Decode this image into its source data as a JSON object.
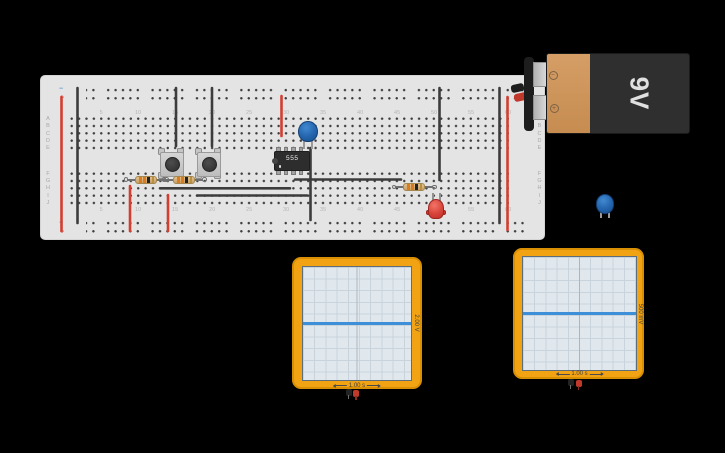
{
  "app": {
    "background": "#000000"
  },
  "breadboard": {
    "x": 40,
    "y": 75,
    "w": 505,
    "h": 165,
    "rail_minus": "−",
    "rail_plus": "+",
    "row_letters_top": [
      "A",
      "B",
      "C",
      "D",
      "E"
    ],
    "row_letters_bottom": [
      "F",
      "G",
      "H",
      "I",
      "J"
    ],
    "column_numbers": [
      5,
      10,
      15,
      20,
      25,
      30,
      35,
      40,
      45,
      50,
      55,
      60
    ],
    "col0_x": 70.5,
    "col_pitch": 7.4,
    "rows_top_y": [
      118,
      125.3,
      132.7,
      140,
      147.3
    ],
    "rows_bottom_y": [
      172.7,
      180,
      187.3,
      194.7,
      202
    ],
    "num_y_top": 112,
    "num_y_bottom": 208.5,
    "letter_x_left": 47,
    "letter_x_right": 538.5
  },
  "wires": [
    {
      "name": "wire-red-left-rail",
      "color": "#d23f31",
      "x1": 61.5,
      "y1": 97,
      "x2": 61.5,
      "y2": 231,
      "w": 2.6
    },
    {
      "name": "wire-black-left-rail",
      "color": "#3c3c3c",
      "x1": 77.5,
      "y1": 88,
      "x2": 77.5,
      "y2": 223,
      "w": 2.6
    },
    {
      "name": "wire-black-button1",
      "color": "#3c3c3c",
      "x1": 176,
      "y1": 88,
      "x2": 176,
      "y2": 146,
      "w": 2.6
    },
    {
      "name": "wire-black-button2",
      "color": "#3c3c3c",
      "x1": 212,
      "y1": 88,
      "x2": 212,
      "y2": 146,
      "w": 2.6
    },
    {
      "name": "wire-red-rowH",
      "color": "#d23f31",
      "x1": 130,
      "y1": 186,
      "x2": 130,
      "y2": 231,
      "w": 2.6
    },
    {
      "name": "wire-red-rowI",
      "color": "#d23f31",
      "x1": 168,
      "y1": 195,
      "x2": 168,
      "y2": 231,
      "w": 2.6
    },
    {
      "name": "wire-red-cap-column",
      "color": "#d23f31",
      "x1": 281.5,
      "y1": 96,
      "x2": 281.5,
      "y2": 136,
      "w": 2.6
    },
    {
      "name": "wire-black-cap-down",
      "color": "#3c3c3c",
      "x1": 310.5,
      "y1": 148,
      "x2": 310.5,
      "y2": 220,
      "w": 2.6
    },
    {
      "name": "wire-black-rowG-horizontal",
      "color": "#3c3c3c",
      "x1": 295,
      "y1": 179.5,
      "x2": 401,
      "y2": 179.5,
      "w": 2.6
    },
    {
      "name": "wire-black-rowH-horizontal",
      "color": "#3c3c3c",
      "x1": 160,
      "y1": 188.3,
      "x2": 290,
      "y2": 188.3,
      "w": 2.6
    },
    {
      "name": "wire-black-rowI-horizontal",
      "color": "#3c3c3c",
      "x1": 197,
      "y1": 195.5,
      "x2": 307,
      "y2": 195.5,
      "w": 2.6
    },
    {
      "name": "wire-black-led-column",
      "color": "#3c3c3c",
      "x1": 439.5,
      "y1": 88,
      "x2": 439.5,
      "y2": 180,
      "w": 2.6
    },
    {
      "name": "wire-black-right-rail",
      "color": "#3c3c3c",
      "x1": 499.5,
      "y1": 88,
      "x2": 499.5,
      "y2": 223,
      "w": 2.6
    },
    {
      "name": "wire-red-right-rail",
      "color": "#d23f31",
      "x1": 507.5,
      "y1": 97,
      "x2": 507.5,
      "y2": 230,
      "w": 2.6
    }
  ],
  "components": {
    "ic555": {
      "label": "555"
    },
    "battery": {
      "label": "9V",
      "minus_symbol": "−",
      "plus_symbol": "+"
    },
    "pushbuttons": [
      {
        "name": "pushbutton-1"
      },
      {
        "name": "pushbutton-2"
      }
    ],
    "resistors": [
      {
        "name": "resistor-1"
      },
      {
        "name": "resistor-2"
      },
      {
        "name": "resistor-3"
      }
    ],
    "led": {
      "color": "red"
    },
    "capacitors": [
      {
        "location": "breadboard"
      },
      {
        "location": "workspace"
      }
    ]
  },
  "oscilloscopes": [
    {
      "voltage_per_div": "2.00 V",
      "time_per_div": "1.00 s"
    },
    {
      "voltage_per_div": "500 mV",
      "time_per_div": "1.00 s"
    }
  ],
  "colors": {
    "wire_red": "#d23f31",
    "wire_black": "#3c3c3c",
    "scope_frame": "#f2a313",
    "scope_screen": "#e1e8ed",
    "scope_trace": "#3d8fd8",
    "battery_orange": "#cf9458",
    "battery_black": "#2f2f2f",
    "resistor_body": "#d9b071",
    "resistor_bands": [
      "#d97b1e",
      "#d97b1e",
      "#222222",
      "#b8903f"
    ],
    "led_red": "#d8443a",
    "cap_blue": "#2567b0",
    "board_bg": "#e4e4e4"
  }
}
